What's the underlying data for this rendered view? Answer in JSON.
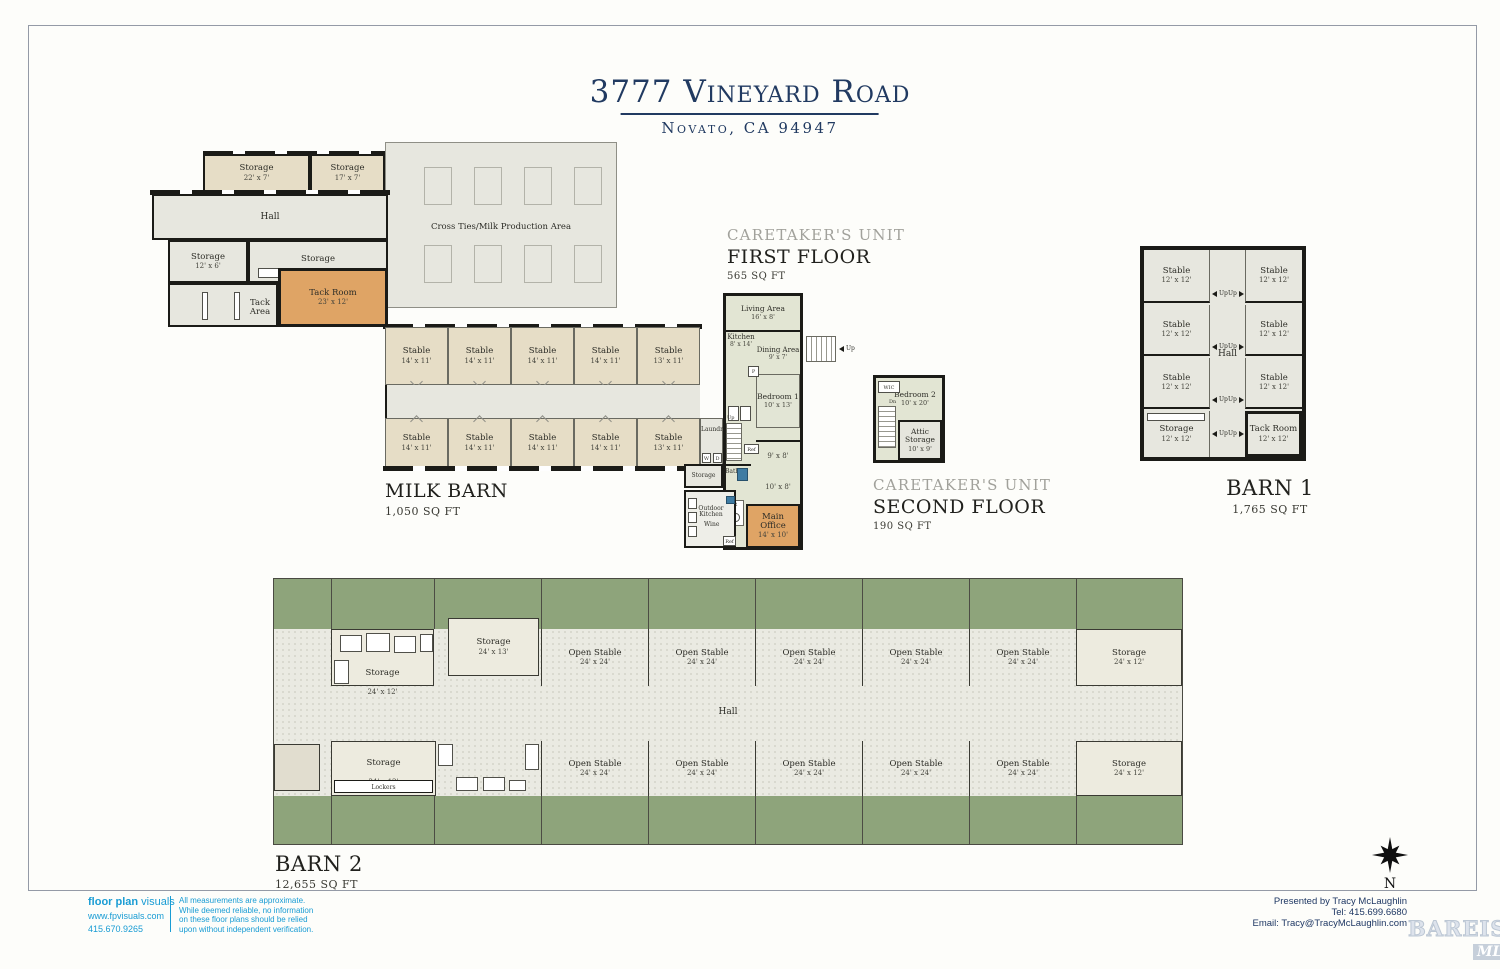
{
  "page": {
    "title": "3777 Vineyard Road",
    "subtitle": "Novato, CA 94947"
  },
  "milk_barn": {
    "label": "MILK BARN",
    "sqft": "1,050 SQ FT",
    "hall": "Hall",
    "cross_ties": "Cross Ties/Milk Production Area",
    "storage_a": {
      "name": "Storage",
      "dims": "22' x 7'"
    },
    "storage_b": {
      "name": "Storage",
      "dims": "17' x 7'"
    },
    "storage_c": {
      "name": "Storage",
      "dims": "12' x 6'"
    },
    "storage_d": {
      "name": "Storage",
      "dims": "37' x 6'"
    },
    "tack_area": "Tack Area",
    "tack_room": {
      "name": "Tack Room",
      "dims": "23' x 12'"
    },
    "laundry": "Laundry",
    "washer": "W",
    "dryer": "D",
    "top_stables": [
      {
        "name": "Stable",
        "dims": "14' x 11'"
      },
      {
        "name": "Stable",
        "dims": "14' x 11'"
      },
      {
        "name": "Stable",
        "dims": "14' x 11'"
      },
      {
        "name": "Stable",
        "dims": "14' x 11'"
      },
      {
        "name": "Stable",
        "dims": "13' x 11'"
      }
    ],
    "bottom_stables": [
      {
        "name": "Stable",
        "dims": "14' x 11'"
      },
      {
        "name": "Stable",
        "dims": "14' x 11'"
      },
      {
        "name": "Stable",
        "dims": "14' x 11'"
      },
      {
        "name": "Stable",
        "dims": "14' x 11'"
      },
      {
        "name": "Stable",
        "dims": "13' x 11'"
      }
    ]
  },
  "caretakers_first": {
    "unit_label": "CARETAKER'S UNIT",
    "floor_label": "FIRST FLOOR",
    "sqft": "565 SQ FT",
    "living": {
      "name": "Living Area",
      "dims": "16' x 8'"
    },
    "kitchen": {
      "name": "Kitchen",
      "dims": "8' x 14'"
    },
    "dining": {
      "name": "Dining Area",
      "dims": "9' x 7'"
    },
    "bedroom1": {
      "name": "Bedroom 1",
      "dims": "10' x 13'"
    },
    "room9x8": "9' x 8'",
    "room10x8": "10' x 8'",
    "bath": "Bath",
    "pr": "PR",
    "pantry": "P",
    "ref": "Ref",
    "up": "Up",
    "storage": "Storage",
    "outdoor_kitchen": "Outdoor Kitchen",
    "wine": "Wine",
    "main_office": {
      "name": "Main Office",
      "dims": "14' x 10'"
    }
  },
  "caretakers_second": {
    "unit_label": "CARETAKER'S UNIT",
    "floor_label": "SECOND FLOOR",
    "sqft": "190 SQ FT",
    "wic": "WIC",
    "dn": "Dn",
    "bedroom2": {
      "name": "Bedroom 2",
      "dims": "10' x 20'"
    },
    "attic": {
      "name": "Attic Storage",
      "dims": "10' x 9'"
    }
  },
  "barn1": {
    "label": "BARN 1",
    "sqft": "1,765 SQ FT",
    "hall": "Hall",
    "up": "Up",
    "left_rooms": [
      {
        "name": "Stable",
        "dims": "12' x 12'"
      },
      {
        "name": "Stable",
        "dims": "12' x 12'"
      },
      {
        "name": "Stable",
        "dims": "12' x 12'"
      },
      {
        "name": "Storage",
        "dims": "12' x 12'"
      }
    ],
    "right_rooms": [
      {
        "name": "Stable",
        "dims": "12' x 12'"
      },
      {
        "name": "Stable",
        "dims": "12' x 12'"
      },
      {
        "name": "Stable",
        "dims": "12' x 12'"
      },
      {
        "name": "Tack Room",
        "dims": "12' x 12'"
      }
    ]
  },
  "barn2": {
    "label": "BARN 2",
    "sqft": "12,655 SQ FT",
    "hall": "Hall",
    "lockers": "Lockers",
    "storage_top_left": {
      "name": "Storage",
      "dims": "24' x 12'"
    },
    "storage_top_mid": {
      "name": "Storage",
      "dims": "24' x 13'"
    },
    "storage_top_right": {
      "name": "Storage",
      "dims": "24' x 12'"
    },
    "storage_bottom_left": {
      "name": "Storage",
      "dims": "24' x 12'"
    },
    "storage_bottom_right": {
      "name": "Storage",
      "dims": "24' x 12'"
    },
    "top_stables": [
      {
        "name": "Open Stable",
        "dims": "24' x 24'"
      },
      {
        "name": "Open Stable",
        "dims": "24' x 24'"
      },
      {
        "name": "Open Stable",
        "dims": "24' x 24'"
      },
      {
        "name": "Open Stable",
        "dims": "24' x 24'"
      },
      {
        "name": "Open Stable",
        "dims": "24' x 24'"
      }
    ],
    "bottom_stables": [
      {
        "name": "Open Stable",
        "dims": "24' x 24'"
      },
      {
        "name": "Open Stable",
        "dims": "24' x 24'"
      },
      {
        "name": "Open Stable",
        "dims": "24' x 24'"
      },
      {
        "name": "Open Stable",
        "dims": "24' x 24'"
      },
      {
        "name": "Open Stable",
        "dims": "24' x 24'"
      }
    ]
  },
  "compass": {
    "north": "N"
  },
  "footer": {
    "logo_bold": "floor plan",
    "logo_light": "visuals",
    "website": "www.fpvisuals.com",
    "phone": "415.670.9265",
    "disclaimer1": "All measurements are approximate.",
    "disclaimer2": "While deemed reliable, no information",
    "disclaimer3": "on these floor plans should be relied",
    "disclaimer4": "upon without independent verification.",
    "presented_by": "Presented by Tracy McLaughlin",
    "tel": "Tel: 415.699.6680",
    "email": "Email: Tracy@TracyMcLaughlin.com"
  },
  "watermark": {
    "line1": "BAREIS",
    "reg": "®",
    "line2": "MLS"
  },
  "colors": {
    "accent_navy": "#1f3864",
    "accent_blue": "#199cd4",
    "grass": "#8ea47b",
    "orange": "#dfa465"
  }
}
